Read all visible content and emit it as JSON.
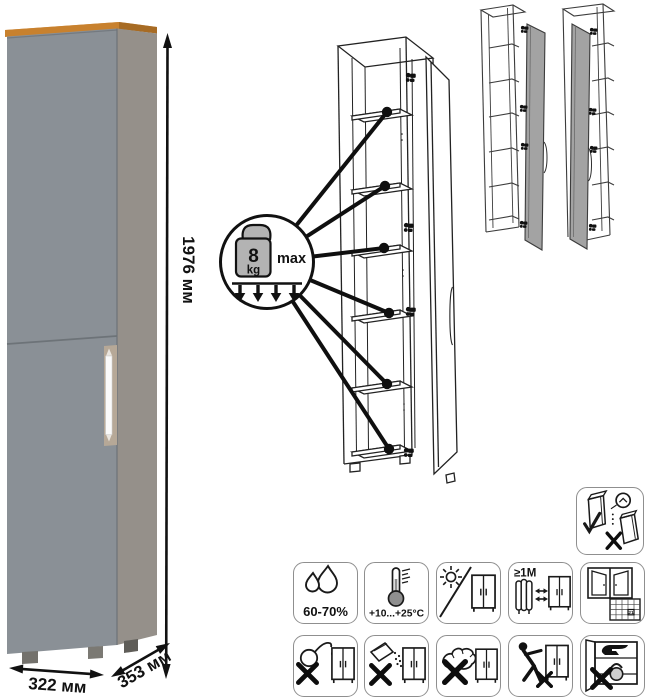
{
  "dimensions": {
    "height": "1976 мм",
    "width": "322 мм",
    "depth": "353 мм"
  },
  "cabinet": {
    "front_color": "#8a9096",
    "side_color": "#95908a",
    "top_wood_color": "#c8812e",
    "handle_color": "#fafafa"
  },
  "shelf_load_callout": {
    "value": "8",
    "unit": "kg",
    "qualifier": "max",
    "pointed_shelves": 6
  },
  "diagrams": {
    "open_cabinet": "open-cabinet-with-shelves",
    "variants": [
      "door-hinged-right",
      "door-hinged-left"
    ]
  },
  "care_icons": {
    "wall_anchor": {
      "icon": "wall-anchor-warning-icon"
    },
    "humidity": {
      "icon": "humidity-icon",
      "label": "60-70%"
    },
    "temperature": {
      "icon": "temperature-icon",
      "label": "+10...+25°C"
    },
    "sunlight": {
      "icon": "no-direct-sunlight-icon"
    },
    "heat_distance": {
      "icon": "keep-1m-from-heaters-icon",
      "label": "≥1М"
    },
    "ventilation": {
      "icon": "ventilation-calendar-icon",
      "calendar_day": "21"
    },
    "no_liquids": {
      "icon": "no-wet-cleaning-icon"
    },
    "no_powder": {
      "icon": "no-abrasive-powder-icon"
    },
    "no_scrubbing": {
      "icon": "no-abrasive-scrubbing-icon"
    },
    "no_dragging": {
      "icon": "no-dragging-icon"
    },
    "no_heavy": {
      "icon": "no-heavy-objects-icon"
    }
  }
}
